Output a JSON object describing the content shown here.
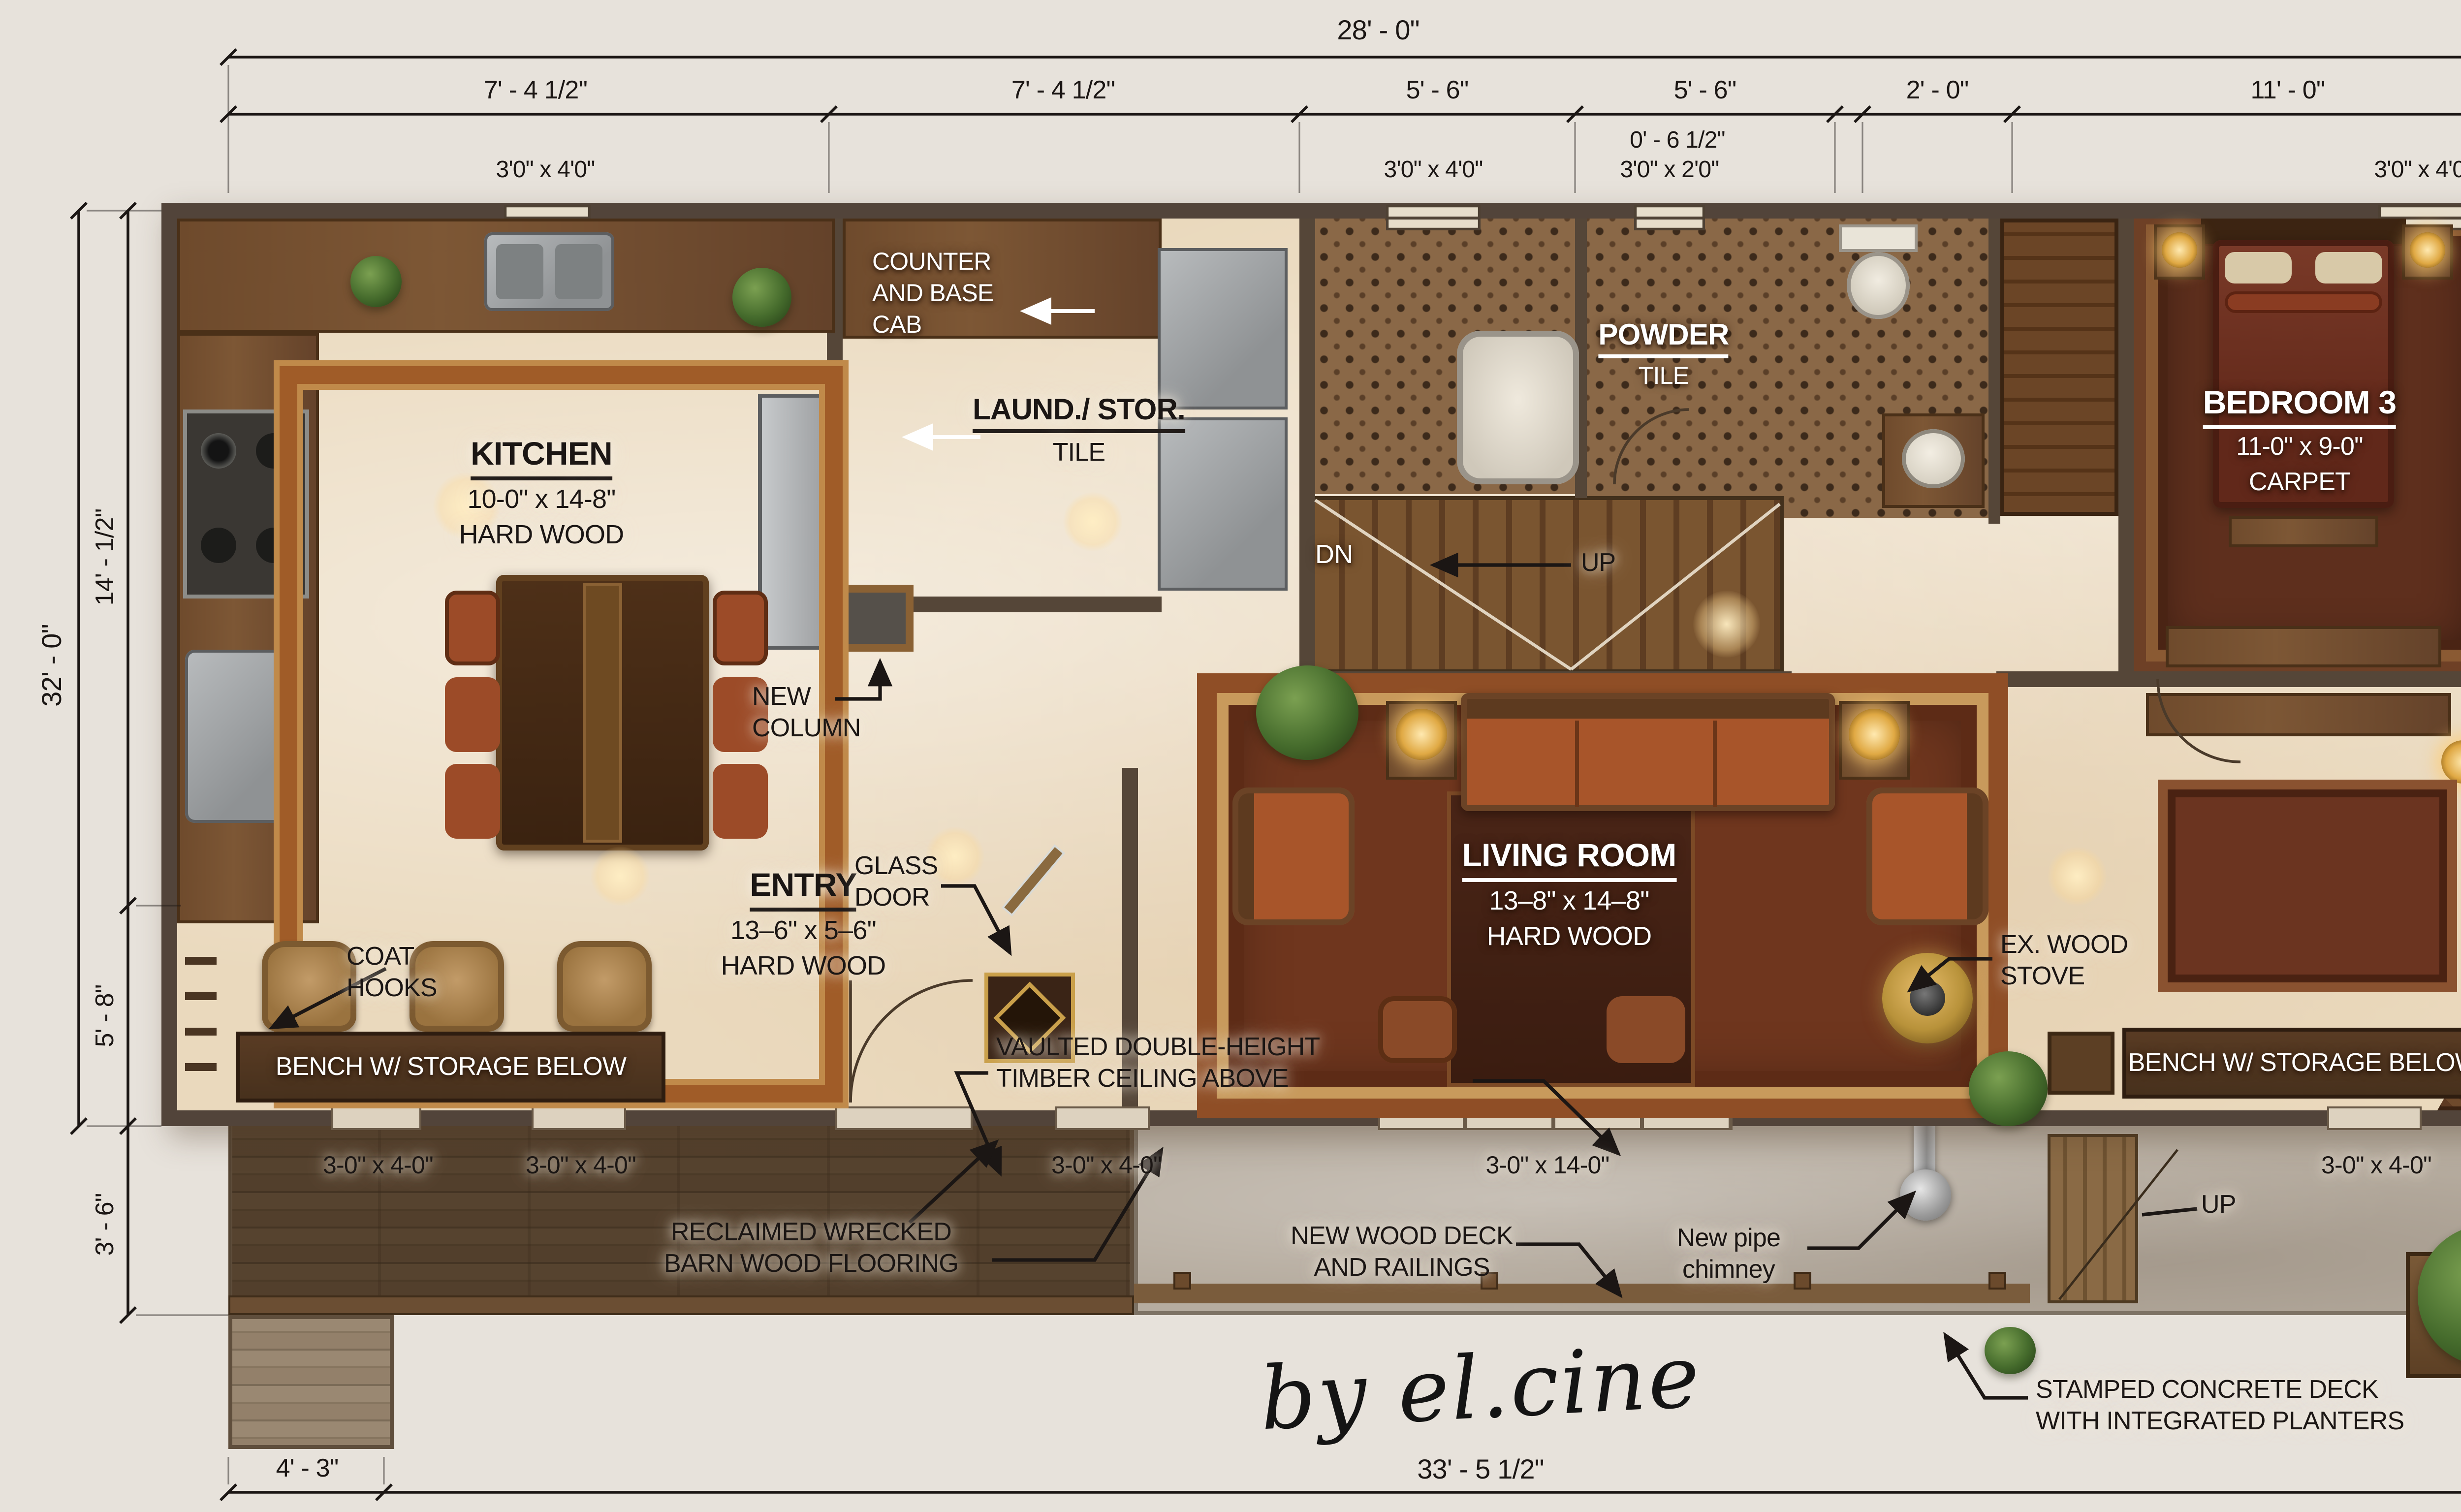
{
  "title": "Remodel floor plan render",
  "colors": {
    "background": "#e7e2db",
    "wall": "#52443a",
    "marble_floor": "#ead9bd",
    "rug_red": "#6f361e",
    "rug_trim": "#8f4e26",
    "carpet": "#6e4026",
    "barn_wood": "#8f7e69",
    "concrete": "#b6ac9f",
    "bench_wood": "#4a3020",
    "gold": "#d8a545",
    "annotation_ink": "#1b1614"
  },
  "dims": {
    "top": {
      "overall": "28' - 0\"",
      "segments": [
        "7' - 4 1/2\"",
        "7' - 4 1/2\"",
        "5' - 6\"",
        "5' - 6\"",
        "0' - 6 1/2\"",
        "2' - 0\"",
        "11' - 0\""
      ],
      "windows": [
        "3'0\" x 4'0\"",
        "3'0\" x 4'0\"",
        "3'0\" x 2'0\"",
        "3'0\" x 4'0\""
      ]
    },
    "left": {
      "overall": "32' - 0\"",
      "segments": [
        "14' - 1/2\"",
        "5' - 8\"",
        "3' - 6\""
      ]
    },
    "right": {
      "overall": "24' - 5\"",
      "segments": [
        "9' - 1 1/4\"",
        "14' - 8\"",
        "3' - 8\""
      ],
      "windows": [
        "3'0\"x4'0\"",
        "3'6\"x4'0\"",
        "3'-0\" x 5'-0\""
      ]
    },
    "bottom": {
      "overall": "33' - 5 1/2\"",
      "porch": "4' - 3\"",
      "openings": [
        "3-0\" x 4-0\"",
        "3-0\" x 4-0\"",
        "3-0\" x 4-0\"",
        "3-0\" x 14-0\"",
        "3-0\" x 4-0\""
      ]
    }
  },
  "rooms": {
    "kitchen": {
      "title": "KITCHEN",
      "size": "10-0\" x 14-8\"",
      "floor": "HARD WOOD"
    },
    "laundry": {
      "title": "LAUND./ STOR.",
      "floor": "TILE"
    },
    "powder": {
      "title": "POWDER",
      "floor": "TILE"
    },
    "bedroom": {
      "title": "BEDROOM 3",
      "size": "11-0\" x 9-0\"",
      "floor": "CARPET"
    },
    "entry": {
      "title": "ENTRY",
      "size": "13–6\" x 5–6\"",
      "floor": "HARD WOOD"
    },
    "living": {
      "title": "LIVING ROOM",
      "size": "13–8\" x 14–8\"",
      "floor": "HARD WOOD"
    }
  },
  "annotations": {
    "counter": [
      "COUNTER",
      "AND BASE",
      "CAB"
    ],
    "dn": "DN",
    "up_stairs": "UP",
    "new_column": [
      "NEW",
      "COLUMN"
    ],
    "glass_door": [
      "GLASS",
      "DOOR"
    ],
    "ex_stove": [
      "EX. WOOD",
      "STOVE"
    ],
    "coat_hooks": [
      "COAT",
      "HOOKS"
    ],
    "bench_left": "BENCH W/ STORAGE BELOW",
    "bench_right": "BENCH W/ STORAGE BELOW",
    "vaulted": [
      "VAULTED DOUBLE-HEIGHT",
      "TIMBER CEILING ABOVE"
    ],
    "reclaimed": [
      "RECLAIMED WRECKED",
      "BARN WOOD FLOORING"
    ],
    "new_deck": [
      "NEW WOOD DECK",
      "AND RAILINGS"
    ],
    "chimney": [
      "New pipe",
      "chimney"
    ],
    "up_deck": "UP",
    "stamped": [
      "STAMPED CONCRETE DECK",
      "WITH INTEGRATED PLANTERS"
    ],
    "signature": "by el.cine"
  }
}
